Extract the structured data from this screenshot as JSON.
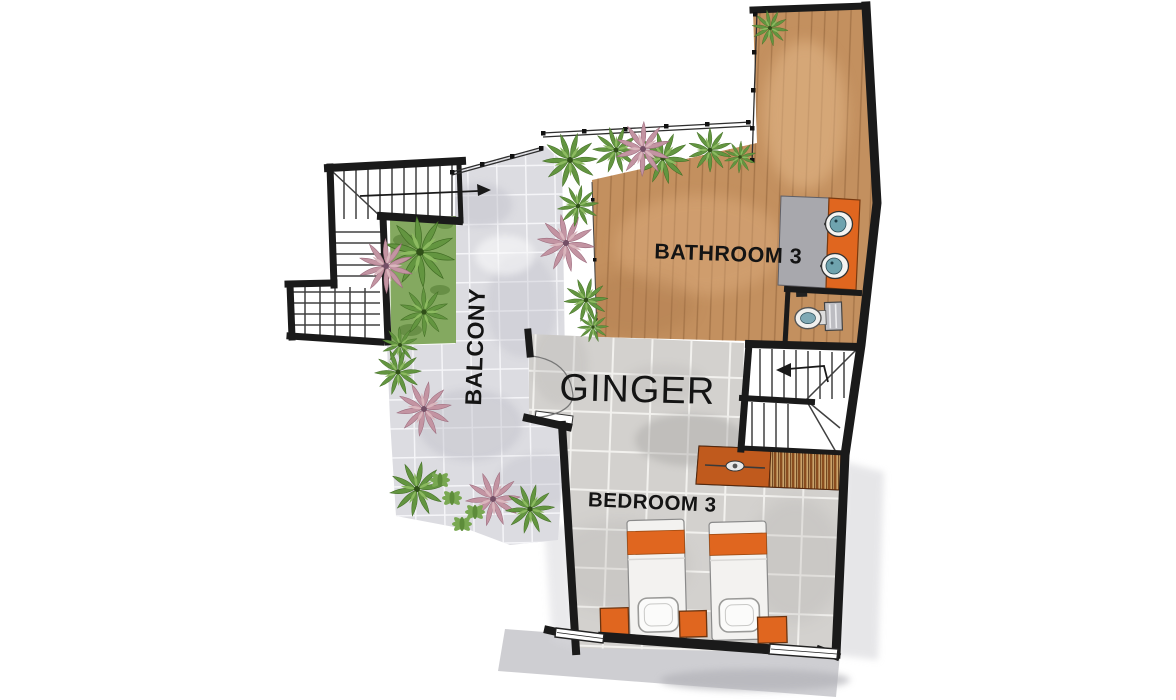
{
  "plan": {
    "title": "GINGER",
    "labels": {
      "unit_name": "GINGER",
      "bathroom": "BATHROOM 3",
      "bedroom": "BEDROOM 3",
      "balcony": "BALCONY"
    }
  },
  "colors": {
    "wall": "#1a1a1a",
    "wood_deck": "#c3905f",
    "floor_tile": "#d3d1ce",
    "paving": "#dcdce1",
    "orange_furniture": "#e0661f",
    "wardrobe_orange": "#c05a1d",
    "sink_basin": "#6fa3ae",
    "plant_green": "#639540",
    "plant_pink": "#c394a2",
    "planter_bed": "#7da457",
    "shadow": "#c9c9cd",
    "background": "#ffffff"
  }
}
